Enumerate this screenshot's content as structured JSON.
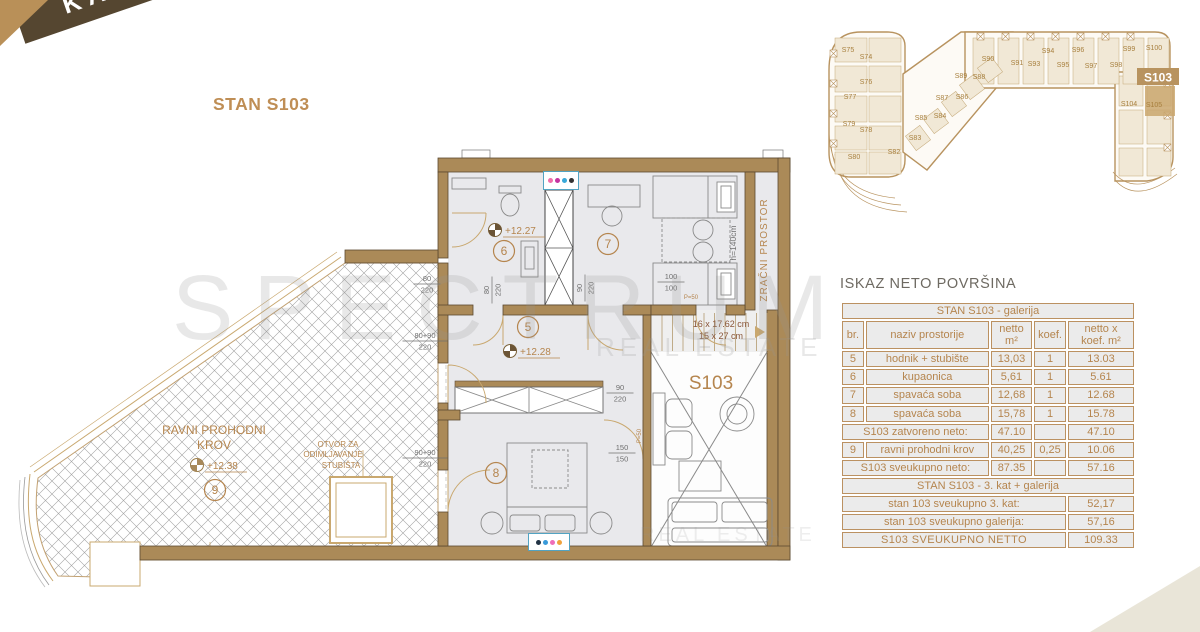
{
  "banner": {
    "label": "KAT"
  },
  "title": "STAN S103",
  "watermark": {
    "line1": "SPECTRUM",
    "line2": "REAL ESTATE",
    "line3": "REAL ESTATE"
  },
  "overview": {
    "highlight": "S103",
    "units": [
      {
        "id": "S75",
        "x": 33,
        "y": 40
      },
      {
        "id": "S74",
        "x": 51,
        "y": 47
      },
      {
        "id": "S76",
        "x": 51,
        "y": 72
      },
      {
        "id": "S77",
        "x": 35,
        "y": 87
      },
      {
        "id": "S79",
        "x": 34,
        "y": 114
      },
      {
        "id": "S78",
        "x": 51,
        "y": 120
      },
      {
        "id": "S80",
        "x": 39,
        "y": 147
      },
      {
        "id": "S82",
        "x": 79,
        "y": 142
      },
      {
        "id": "S83",
        "x": 100,
        "y": 128
      },
      {
        "id": "S85",
        "x": 106,
        "y": 108
      },
      {
        "id": "S84",
        "x": 125,
        "y": 106
      },
      {
        "id": "S87",
        "x": 127,
        "y": 88
      },
      {
        "id": "S86",
        "x": 147,
        "y": 87
      },
      {
        "id": "S89",
        "x": 146,
        "y": 66
      },
      {
        "id": "S88",
        "x": 164,
        "y": 67
      },
      {
        "id": "S90",
        "x": 173,
        "y": 49
      },
      {
        "id": "S91",
        "x": 202,
        "y": 53
      },
      {
        "id": "S93",
        "x": 219,
        "y": 54
      },
      {
        "id": "S94",
        "x": 233,
        "y": 41
      },
      {
        "id": "S95",
        "x": 248,
        "y": 55
      },
      {
        "id": "S96",
        "x": 263,
        "y": 40
      },
      {
        "id": "S97",
        "x": 276,
        "y": 56
      },
      {
        "id": "S98",
        "x": 301,
        "y": 55
      },
      {
        "id": "S99",
        "x": 314,
        "y": 39
      },
      {
        "id": "S100",
        "x": 339,
        "y": 38
      },
      {
        "id": "S104",
        "x": 314,
        "y": 94
      },
      {
        "id": "S105",
        "x": 339,
        "y": 95
      }
    ]
  },
  "plan": {
    "texts": [
      {
        "t": "ZRAČNI PROSTOR",
        "x": 767,
        "y": 250,
        "s": 10,
        "c": "gold",
        "r": -90,
        "ls": 1
      },
      {
        "t": "h=140cm",
        "x": 736,
        "y": 243,
        "s": 8.5,
        "c": "dim",
        "r": -90
      },
      {
        "t": "RAVNI PROHODNI",
        "x": 214,
        "y": 434,
        "s": 12,
        "c": "gold"
      },
      {
        "t": "KROV",
        "x": 214,
        "y": 449,
        "s": 12,
        "c": "gold"
      },
      {
        "t": "OTVOR ZA",
        "x": 338,
        "y": 447,
        "s": 8,
        "c": "gold"
      },
      {
        "t": "ODIMLJAVANJE",
        "x": 333,
        "y": 457,
        "s": 8,
        "c": "gold"
      },
      {
        "t": "STUBIŠTA",
        "x": 341,
        "y": 468,
        "s": 8,
        "c": "gold"
      },
      {
        "t": "16 x 17.62 cm",
        "x": 721,
        "y": 327,
        "s": 9,
        "c": "stair"
      },
      {
        "t": "15 x 27 cm",
        "x": 721,
        "y": 339,
        "s": 9,
        "c": "stair"
      },
      {
        "t": "S103",
        "x": 711,
        "y": 389,
        "s": 19,
        "c": "gold"
      },
      {
        "t": "P=50",
        "x": 691,
        "y": 299,
        "s": 6,
        "c": "gold"
      },
      {
        "t": "P=50",
        "x": 641,
        "y": 436,
        "s": 6,
        "c": "gold",
        "r": -90
      },
      {
        "t": "+12.27",
        "x": 505,
        "y": 234,
        "s": 10,
        "c": "gold",
        "a": "s"
      },
      {
        "t": "+12.28",
        "x": 520,
        "y": 355,
        "s": 10,
        "c": "gold",
        "a": "s"
      },
      {
        "t": "+12.38",
        "x": 207,
        "y": 469,
        "s": 10,
        "c": "gold",
        "a": "s"
      },
      {
        "t": "6",
        "x": 504,
        "y": 251,
        "circ": 1
      },
      {
        "t": "7",
        "x": 608,
        "y": 244,
        "circ": 1
      },
      {
        "t": "5",
        "x": 528,
        "y": 327,
        "circ": 1
      },
      {
        "t": "8",
        "x": 496,
        "y": 473,
        "circ": 1
      },
      {
        "t": "9",
        "x": 215,
        "y": 490,
        "circ": 1
      }
    ],
    "fracs": [
      {
        "num": "80",
        "den": "220",
        "x": 427,
        "y": 283
      },
      {
        "num": "80+90",
        "den": "220",
        "x": 425,
        "y": 340
      },
      {
        "num": "90+90",
        "den": "220",
        "x": 425,
        "y": 457
      },
      {
        "num": "80",
        "den": "220",
        "x": 491,
        "y": 290,
        "r": -90
      },
      {
        "num": "90",
        "den": "220",
        "x": 584,
        "y": 288,
        "r": -90
      },
      {
        "num": "90",
        "den": "220",
        "x": 620,
        "y": 392
      },
      {
        "num": "150",
        "den": "150",
        "x": 622,
        "y": 452
      },
      {
        "num": "100",
        "den": "100",
        "x": 671,
        "y": 281
      }
    ]
  },
  "areas": {
    "heading": "ISKAZ NETO POVRŠINA",
    "galerija": {
      "title": "STAN S103 - galerija",
      "columns": [
        "br.",
        "naziv prostorije",
        "netto m²",
        "koef.",
        "netto x koef. m²"
      ],
      "rows": [
        [
          "5",
          "hodnik + stubište",
          "13,03",
          "1",
          "13.03"
        ],
        [
          "6",
          "kupaonica",
          "5,61",
          "1",
          "5.61"
        ],
        [
          "7",
          "spavaća soba",
          "12,68",
          "1",
          "12.68"
        ],
        [
          "8",
          "spavaća soba",
          "15,78",
          "1",
          "15.78"
        ]
      ],
      "zatvoreno": {
        "label": "S103 zatvoreno neto:",
        "netto": "47.10",
        "koef": "",
        "total": "47.10"
      },
      "krov": [
        "9",
        "ravni prohodni krov",
        "40,25",
        "0,25",
        "10.06"
      ],
      "sveukupno": {
        "label": "S103 sveukupno neto:",
        "netto": "87.35",
        "koef": "",
        "total": "57.16"
      }
    },
    "kat": {
      "title": "STAN S103 - 3. kat + galerija",
      "rows": [
        [
          "stan 103 sveukupno 3. kat:",
          "52,17"
        ],
        [
          "stan 103 sveukupno galerija:",
          "57,16"
        ]
      ],
      "total": {
        "label": "S103 SVEUKUPNO NETTO",
        "value": "109.33"
      }
    }
  }
}
